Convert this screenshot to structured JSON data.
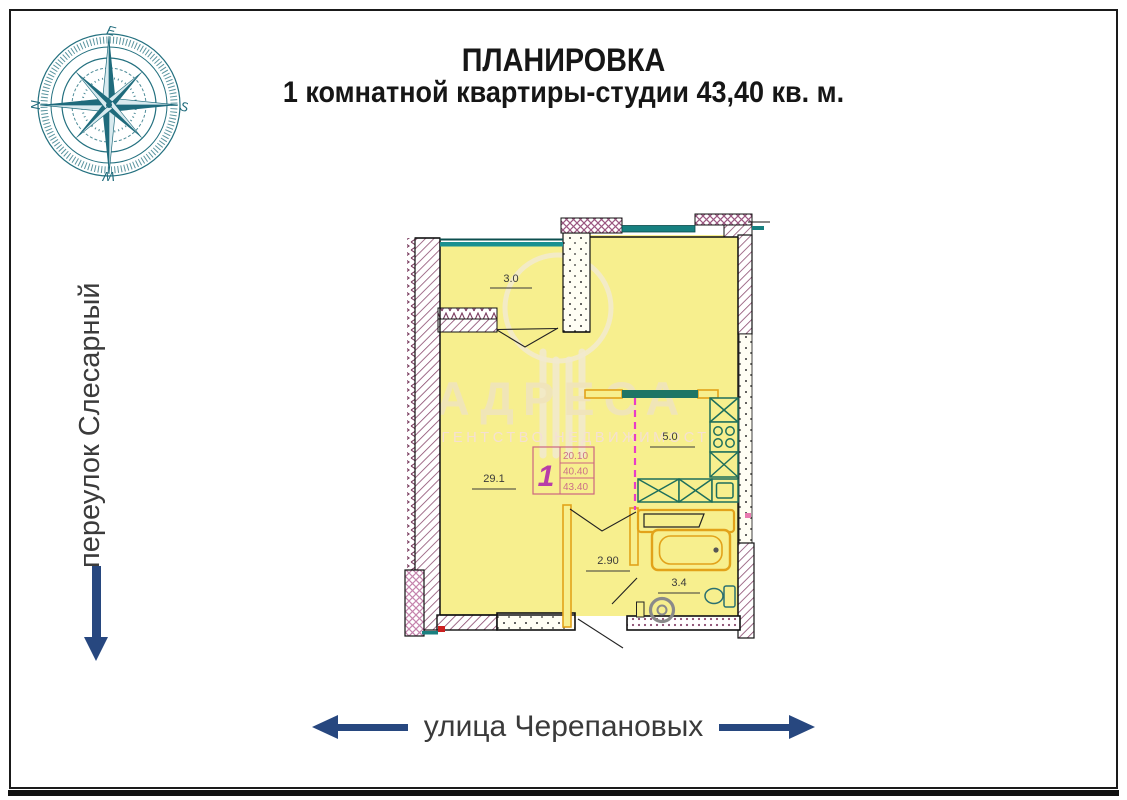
{
  "title": {
    "line1": "ПЛАНИРОВКА",
    "line2": "1 комнатной квартиры-студии 43,40 кв. м."
  },
  "streets": {
    "left_vertical": "переулок Слесарный",
    "bottom_horizontal": "улица Черепановых"
  },
  "compass": {
    "north": "N",
    "east": "E",
    "south": "S",
    "west": "W"
  },
  "floor_plan": {
    "room_areas": {
      "balcony": "3.0",
      "living_room": "29.1",
      "kitchen": "5.0",
      "hallway": "2.90",
      "bathroom": "3.4"
    },
    "apartment_stamp": {
      "rooms": "1",
      "values": [
        "20.10",
        "40.40",
        "43.40"
      ]
    }
  },
  "watermark": {
    "brand": "АДРЕСА",
    "subtitle": "АГЕНТСТВО НЕДВИЖИМОСТИ"
  },
  "colors": {
    "floor_fill": "#f7ef8e",
    "wall_hatch": "#8a4a6e",
    "cross_hatch": "#c583ad",
    "window_teal": "#178080",
    "counter_green": "#1e6f5c",
    "partition_orange": "#e2a21a",
    "stamp_pink": "#cc6680",
    "stamp_number": "#b83da8",
    "dashed_magenta": "#e83cc8",
    "arrow_navy": "#27477f",
    "compass_teal": "#23707f",
    "watermark_cream": "#f0e4bc"
  }
}
